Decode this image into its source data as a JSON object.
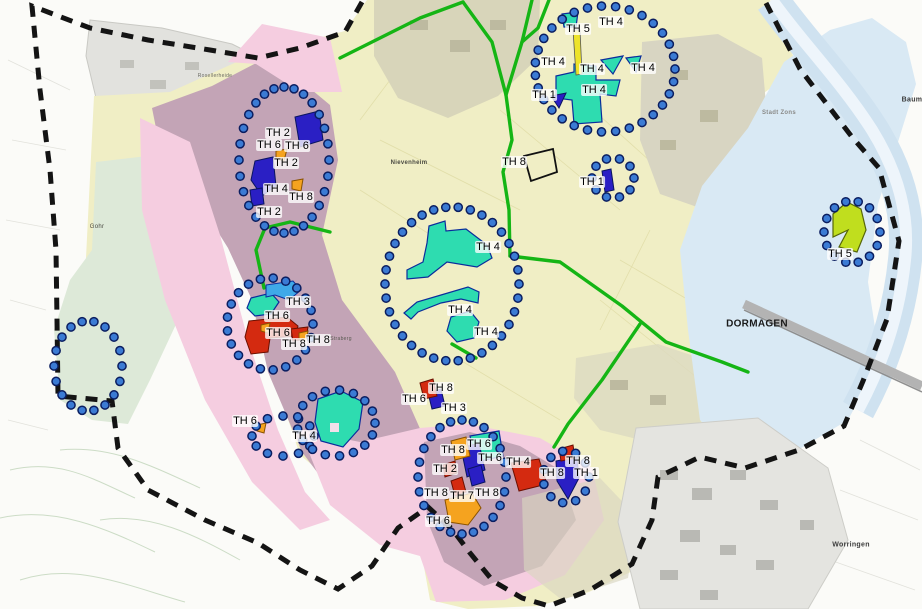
{
  "map": {
    "type": "municipal-planning-map",
    "region_name": "DORMAGEN",
    "palette": {
      "site_teal": "#2edcb0",
      "site_blue": "#2a1fc4",
      "site_red": "#d42a10",
      "site_orange": "#f5a31f",
      "site_skyblue": "#3fa9e8",
      "site_chartreuse": "#c0de1e",
      "site_yellow": "#ede32a",
      "dot_fill": "#3b7bd4",
      "dot_stroke": "#0b1e60",
      "road_green": "#15b515",
      "boundary_black": "#141414",
      "zone_yellow": "#f0eec5",
      "zone_mauve": "#c3a4b6",
      "zone_pink": "#f5cde0",
      "zone_green": "#dde9d8",
      "zone_blue": "#d9e9f4"
    },
    "site_labels": [
      {
        "text": "TH 5",
        "x": 578,
        "y": 29
      },
      {
        "text": "TH 4",
        "x": 611,
        "y": 22
      },
      {
        "text": "TH 4",
        "x": 553,
        "y": 62
      },
      {
        "text": "TH 4",
        "x": 592,
        "y": 69
      },
      {
        "text": "TH 4",
        "x": 643,
        "y": 68
      },
      {
        "text": "TH 1",
        "x": 544,
        "y": 95
      },
      {
        "text": "TH 4",
        "x": 594,
        "y": 90
      },
      {
        "text": "TH 8",
        "x": 514,
        "y": 162
      },
      {
        "text": "TH 1",
        "x": 592,
        "y": 182
      },
      {
        "text": "TH 2",
        "x": 278,
        "y": 133
      },
      {
        "text": "TH 6",
        "x": 269,
        "y": 145
      },
      {
        "text": "TH 6",
        "x": 297,
        "y": 146
      },
      {
        "text": "TH 2",
        "x": 286,
        "y": 163
      },
      {
        "text": "TH 4",
        "x": 276,
        "y": 189
      },
      {
        "text": "TH 8",
        "x": 301,
        "y": 197
      },
      {
        "text": "TH 2",
        "x": 269,
        "y": 212
      },
      {
        "text": "TH 4",
        "x": 488,
        "y": 247
      },
      {
        "text": "TH 4",
        "x": 460,
        "y": 310
      },
      {
        "text": "TH 4",
        "x": 486,
        "y": 332
      },
      {
        "text": "TH 3",
        "x": 298,
        "y": 302
      },
      {
        "text": "TH 6",
        "x": 277,
        "y": 316
      },
      {
        "text": "TH 6",
        "x": 278,
        "y": 333
      },
      {
        "text": "TH 8",
        "x": 294,
        "y": 344
      },
      {
        "text": "TH 8",
        "x": 318,
        "y": 340
      },
      {
        "text": "TH 6",
        "x": 245,
        "y": 421
      },
      {
        "text": "TH 4",
        "x": 304,
        "y": 436
      },
      {
        "text": "TH 8",
        "x": 441,
        "y": 388
      },
      {
        "text": "TH 6",
        "x": 414,
        "y": 399
      },
      {
        "text": "TH 3",
        "x": 454,
        "y": 408
      },
      {
        "text": "TH 8",
        "x": 453,
        "y": 450
      },
      {
        "text": "TH 6",
        "x": 479,
        "y": 444
      },
      {
        "text": "TH 6",
        "x": 490,
        "y": 458
      },
      {
        "text": "TH 4",
        "x": 518,
        "y": 462
      },
      {
        "text": "TH 2",
        "x": 445,
        "y": 469
      },
      {
        "text": "TH 8",
        "x": 436,
        "y": 493
      },
      {
        "text": "TH 7",
        "x": 462,
        "y": 496
      },
      {
        "text": "TH 8",
        "x": 487,
        "y": 493
      },
      {
        "text": "TH 6",
        "x": 438,
        "y": 521
      },
      {
        "text": "TH 8",
        "x": 578,
        "y": 461
      },
      {
        "text": "TH 8",
        "x": 552,
        "y": 473
      },
      {
        "text": "TH 1",
        "x": 586,
        "y": 473
      },
      {
        "text": "TH 5",
        "x": 840,
        "y": 254
      }
    ],
    "town_labels": [
      {
        "text": "Rosellerheide",
        "x": 215,
        "y": 76,
        "size": 5,
        "bold": false,
        "color": "#6a6a62"
      },
      {
        "text": "Nievenheim",
        "x": 409,
        "y": 163,
        "size": 6,
        "bold": true,
        "color": "#4a4a42"
      },
      {
        "text": "Gohr",
        "x": 97,
        "y": 227,
        "size": 6,
        "bold": false,
        "color": "#4a4a42"
      },
      {
        "text": "Straberg",
        "x": 341,
        "y": 339,
        "size": 5,
        "bold": false,
        "color": "#5a5a52"
      },
      {
        "text": "Stadt Zons",
        "x": 779,
        "y": 113,
        "size": 6,
        "bold": true,
        "color": "#8a8a88"
      },
      {
        "text": "DORMAGEN",
        "x": 757,
        "y": 324,
        "size": 10,
        "bold": true,
        "color": "#1a1a1a"
      },
      {
        "text": "Worringen",
        "x": 851,
        "y": 545,
        "size": 7,
        "bold": true,
        "color": "#3a3a3a"
      },
      {
        "text": "Baum",
        "x": 912,
        "y": 100,
        "size": 7,
        "bold": true,
        "color": "#3a3a3a"
      }
    ],
    "dotted_circles": [
      {
        "cx": 605,
        "cy": 69,
        "rx": 70,
        "ry": 63
      },
      {
        "cx": 613,
        "cy": 178,
        "rx": 21,
        "ry": 20
      },
      {
        "cx": 284,
        "cy": 160,
        "rx": 45,
        "ry": 73
      },
      {
        "cx": 452,
        "cy": 284,
        "rx": 67,
        "ry": 77
      },
      {
        "cx": 270,
        "cy": 324,
        "rx": 43,
        "ry": 46
      },
      {
        "cx": 88,
        "cy": 366,
        "rx": 34,
        "ry": 45
      },
      {
        "cx": 283,
        "cy": 436,
        "rx": 31,
        "ry": 20
      },
      {
        "cx": 336,
        "cy": 423,
        "rx": 39,
        "ry": 33
      },
      {
        "cx": 462,
        "cy": 477,
        "rx": 44,
        "ry": 57
      },
      {
        "cx": 566,
        "cy": 477,
        "rx": 23,
        "ry": 26
      },
      {
        "cx": 852,
        "cy": 232,
        "rx": 28,
        "ry": 31
      }
    ]
  }
}
